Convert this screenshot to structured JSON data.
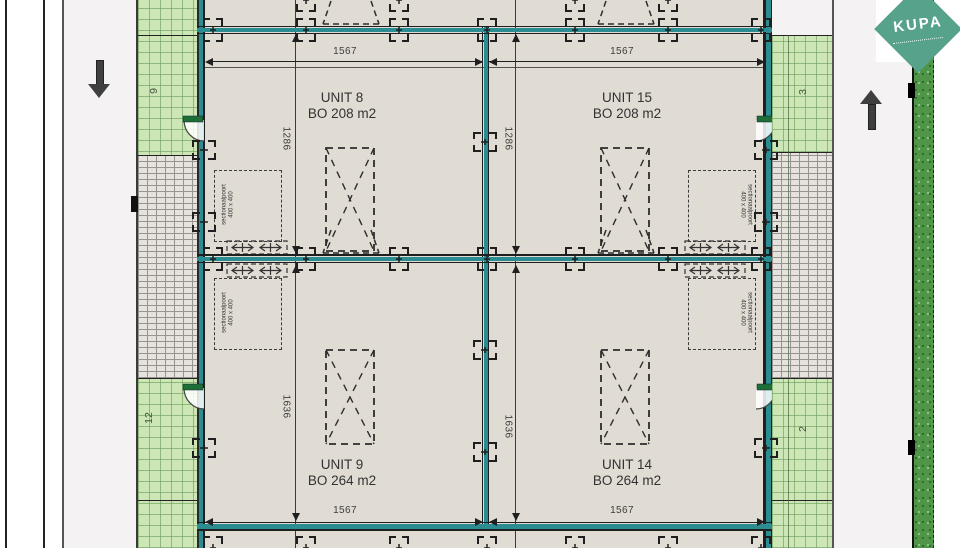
{
  "logo": {
    "brand": "KUPA"
  },
  "parcels": {
    "left_top": "9",
    "left_bottom": "12",
    "right_top": "3",
    "right_bottom": "2"
  },
  "units": {
    "unit8": {
      "name": "UNIT 8",
      "area": "BO 208 m2"
    },
    "unit15": {
      "name": "UNIT 15",
      "area": "BO 208 m2"
    },
    "unit9": {
      "name": "UNIT 9",
      "area": "BO 264 m2"
    },
    "unit14": {
      "name": "UNIT 14",
      "area": "BO 264 m2"
    }
  },
  "dimensions": {
    "width_top_left": "1567",
    "width_top_right": "1567",
    "width_bottom_left": "1567",
    "width_bottom_right": "1567",
    "depth_top_left": "1286",
    "depth_top_right": "1286",
    "depth_bottom_left": "1636",
    "depth_bottom_right": "1636"
  },
  "door_label": {
    "line1": "sectionaalpoort",
    "line2": "400 x 400"
  },
  "colors": {
    "teal_wall": "#2B8C91",
    "wall_black": "#1F1F1F",
    "green_fill": "#CDE6B5",
    "green_grid": "#76A968",
    "hedge_green": "#4F9648",
    "pavement": "#E6E3DF",
    "interior": "#E0DCD4",
    "road": "#F4F2F3",
    "logo_green": "#57A28A",
    "door_green": "#1E6E38"
  }
}
